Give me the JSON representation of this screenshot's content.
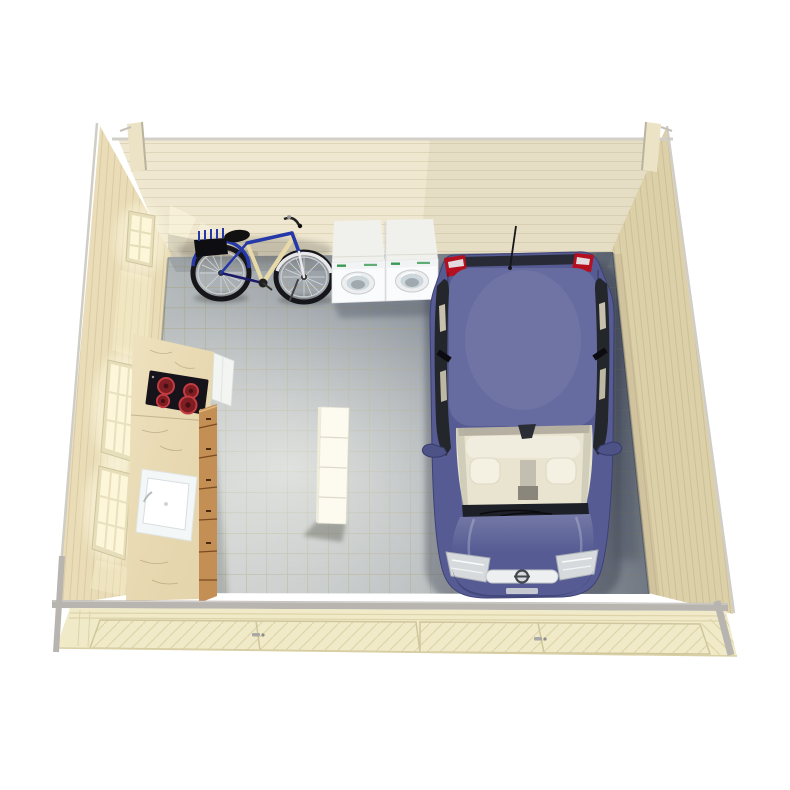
{
  "scene": {
    "label": "3D product render, top-down interior view of a wooden log garage / garden house with a parked car, bicycle, two laundry machines, kitchenette counter and a white shelf",
    "view": "bird's-eye isometric",
    "background": "#ffffff"
  },
  "colors": {
    "background": "#ffffff",
    "wall_back": "#efe7d0",
    "wall_left": "#e9dcb6",
    "wall_right": "#dcd0a8",
    "plank_line": "#ddd4b8",
    "trim_gray": "#b8b5b1",
    "door_wood": "#f1eac9",
    "floor_light": "#cbcecd",
    "floor_dark": "#7a828e",
    "tile_grout": "#a5a27c",
    "counter_marble": "#e9dab2",
    "cabinet_wood": "#c38f55",
    "cooktop_black": "#17131a",
    "burner_red": "#b2262e",
    "sink_white": "#f4f7f7",
    "shelf_white": "#fdfaf0",
    "washer_white": "#fafbfc",
    "washer_top": "#f0f1ec",
    "washer_door": "#cdd6da",
    "green_led": "#3a9a55",
    "bike_blue": "#2438a8",
    "car_body": "#565c93",
    "car_roof": "#666ca0",
    "car_glass": "#23262b",
    "car_interior": "#e9e4d0",
    "taillight_red": "#b5101f",
    "headlight_silver": "#d6dadd",
    "window_glow": "#fdf6d8"
  },
  "objects": {
    "back_wall": {
      "label": "back wall of horizontal spruce planks"
    },
    "left_wall": {
      "label": "left wall with glazed daylight windows"
    },
    "right_wall": {
      "label": "right wall of spruce planks"
    },
    "floor": {
      "label": "grey tiled floor"
    },
    "car": {
      "label": "dark blue hatchback parked facing the garage doors"
    },
    "bicycle": {
      "label": "blue and white city bicycle leaning against the back wall"
    },
    "washer_left": {
      "label": "white washing machine"
    },
    "washer_right": {
      "label": "white tumble dryer"
    },
    "counter": {
      "label": "kitchenette counter with marble worktop"
    },
    "cooktop": {
      "label": "black cooktop with four red burners"
    },
    "sink": {
      "label": "white inset sink"
    },
    "drawers": {
      "label": "wooden drawer fronts of the counter"
    },
    "appliance": {
      "label": "small white appliance beside the counter"
    },
    "shelf": {
      "label": "white storage shelf standing on the floor"
    },
    "front_wall": {
      "label": "front wall with double wooden garage doors, seen from outside"
    },
    "door_left": {
      "label": "left garage door pair"
    },
    "door_right": {
      "label": "right garage door pair"
    },
    "window_top": {
      "label": "small window, back of left wall"
    },
    "window_middle": {
      "label": "tall window, middle of left wall"
    },
    "window_front": {
      "label": "tall window, front of left wall"
    }
  }
}
